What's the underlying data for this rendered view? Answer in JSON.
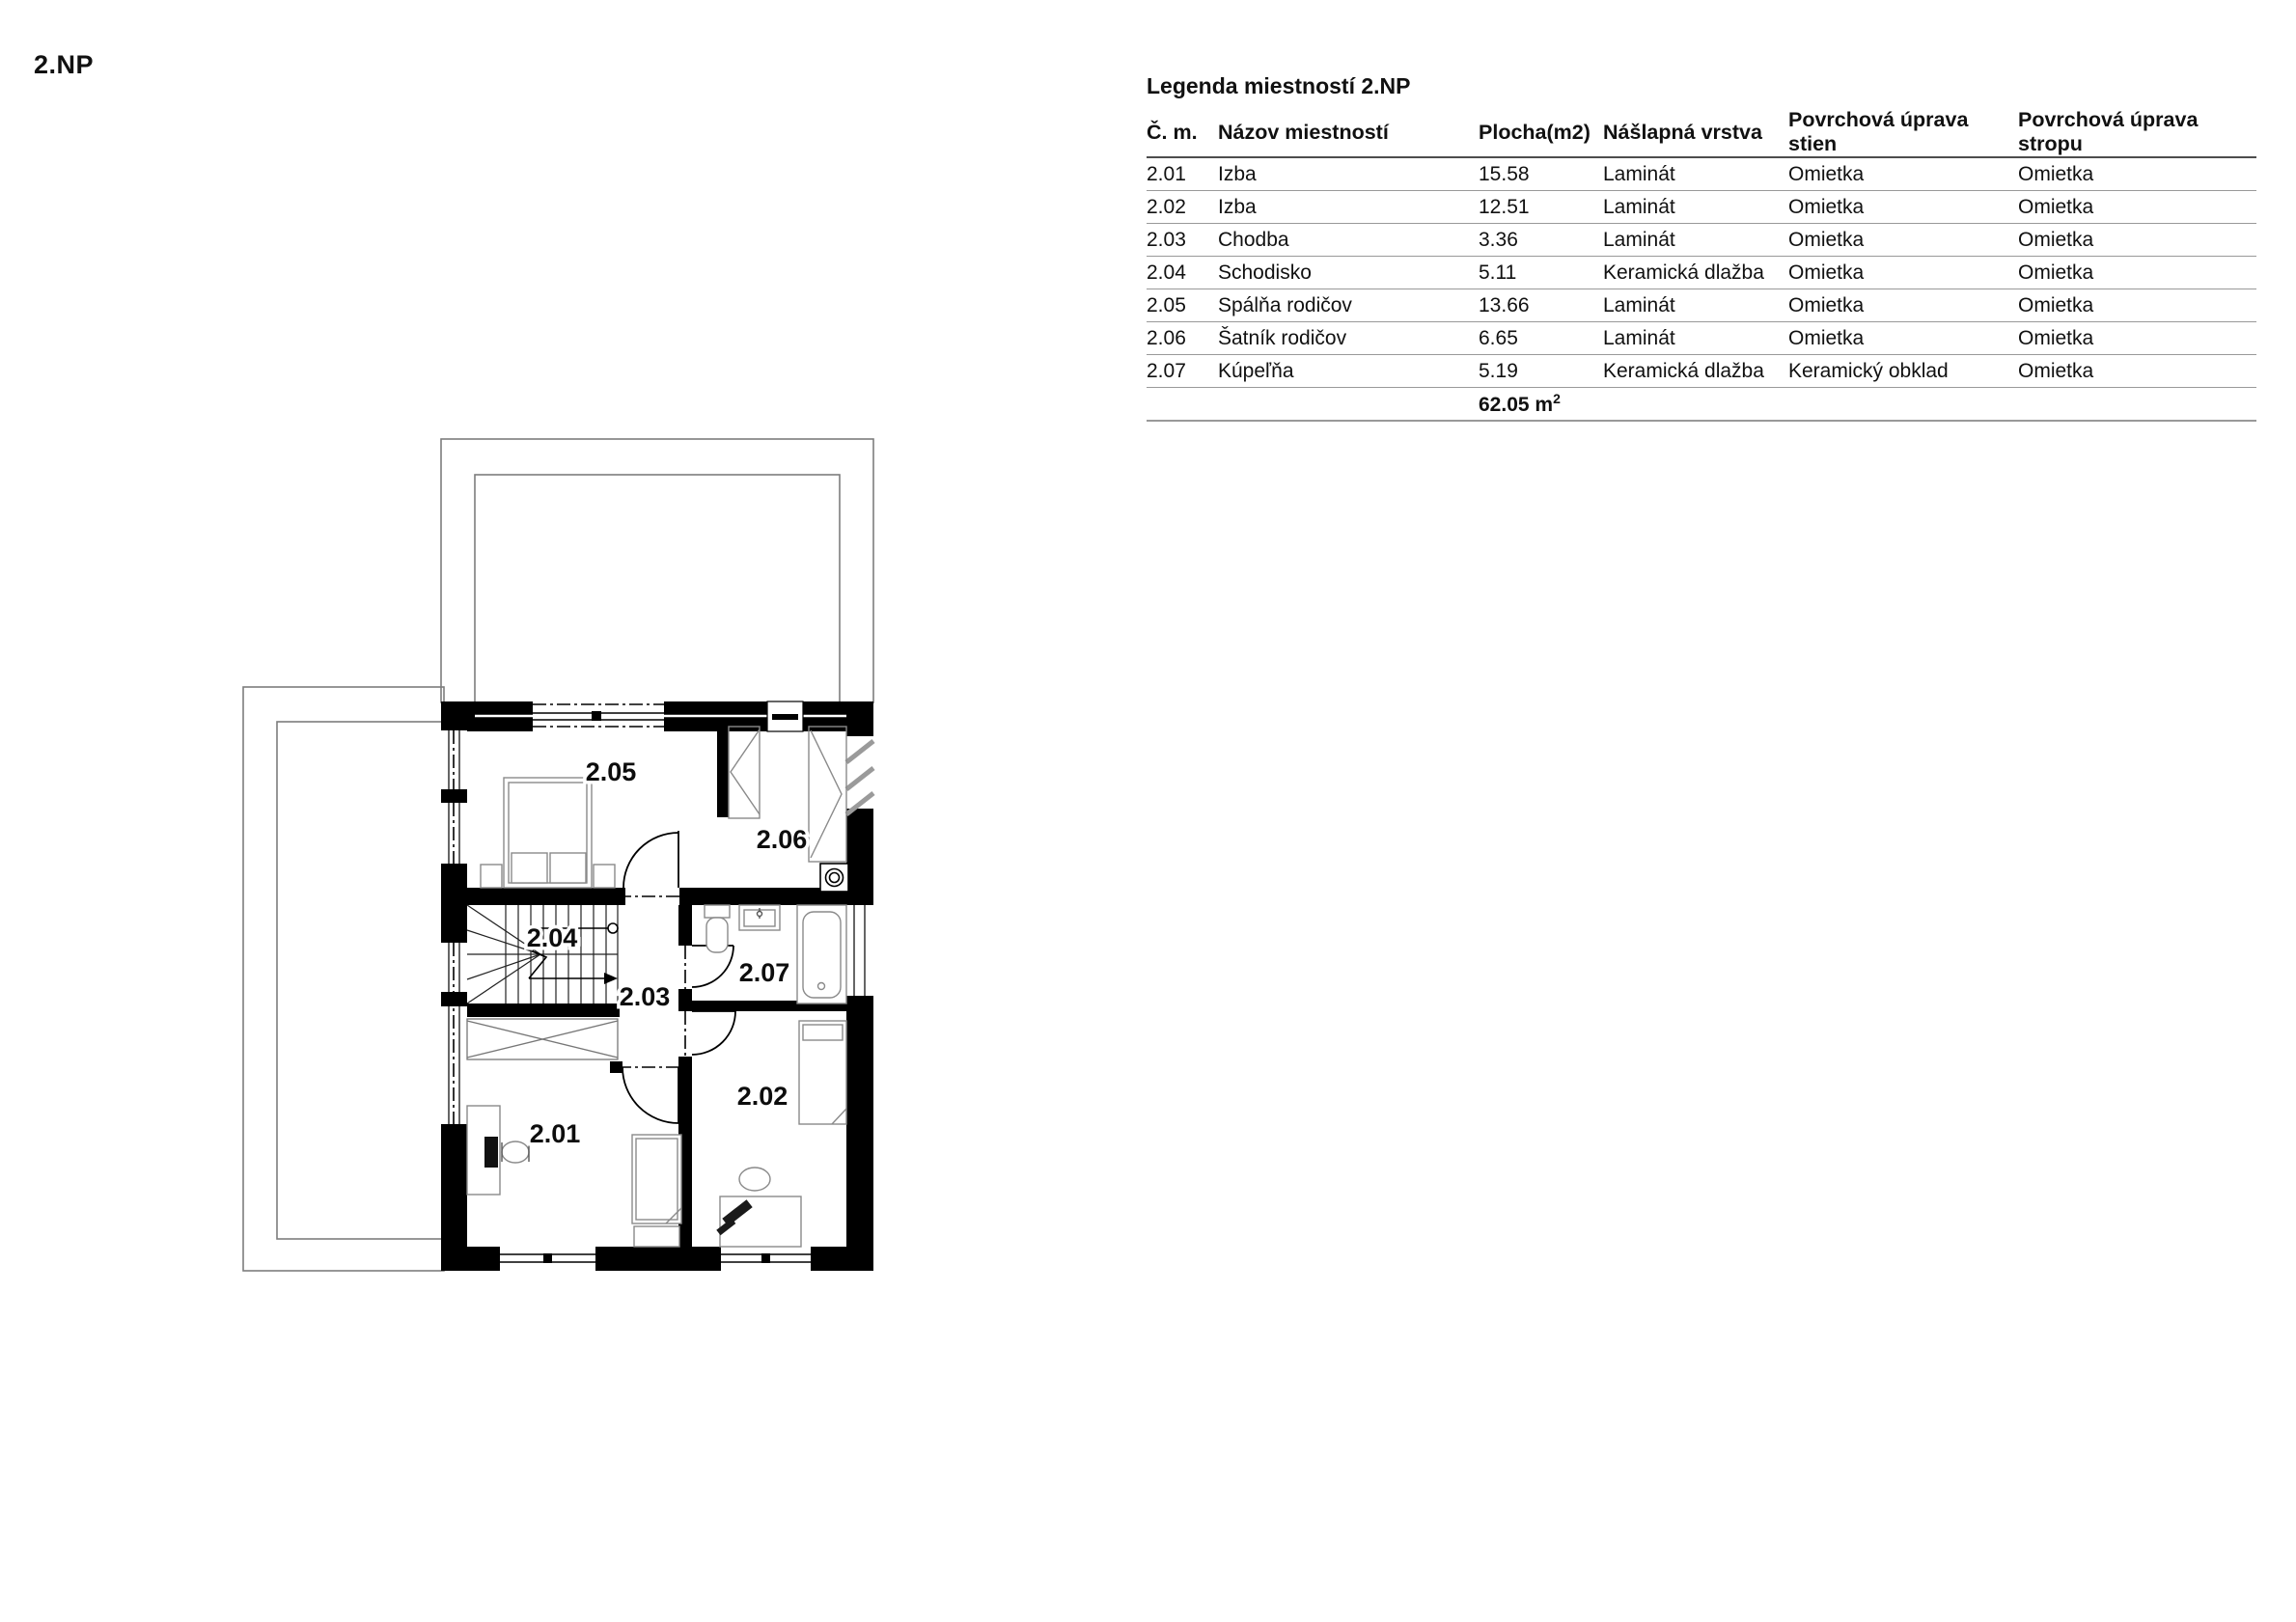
{
  "page": {
    "title": "2.NP"
  },
  "legend": {
    "title": "Legenda miestností 2.NP",
    "columns": [
      "Č. m.",
      "Názov miestností",
      "Plocha(m2)",
      "Nášlapná vrstva",
      "Povrchová úprava stien",
      "Povrchová úprava stropu"
    ],
    "rows": [
      [
        "2.01",
        "Izba",
        "15.58",
        "Laminát",
        "Omietka",
        "Omietka"
      ],
      [
        "2.02",
        "Izba",
        "12.51",
        "Laminát",
        "Omietka",
        "Omietka"
      ],
      [
        "2.03",
        "Chodba",
        "3.36",
        "Laminát",
        "Omietka",
        "Omietka"
      ],
      [
        "2.04",
        "Schodisko",
        "5.11",
        "Keramická dlažba",
        "Omietka",
        "Omietka"
      ],
      [
        "2.05",
        "Spálňa rodičov",
        "13.66",
        "Laminát",
        "Omietka",
        "Omietka"
      ],
      [
        "2.06",
        "Šatník rodičov",
        "6.65",
        "Laminát",
        "Omietka",
        "Omietka"
      ],
      [
        "2.07",
        "Kúpeľňa",
        "5.19",
        "Keramická dlažba",
        "Keramický obklad",
        "Omietka"
      ]
    ],
    "total_value": "62.05 m",
    "total_sup": "2"
  },
  "floorplan": {
    "room_labels": [
      "2.01",
      "2.02",
      "2.03",
      "2.04",
      "2.05",
      "2.06",
      "2.07"
    ]
  }
}
